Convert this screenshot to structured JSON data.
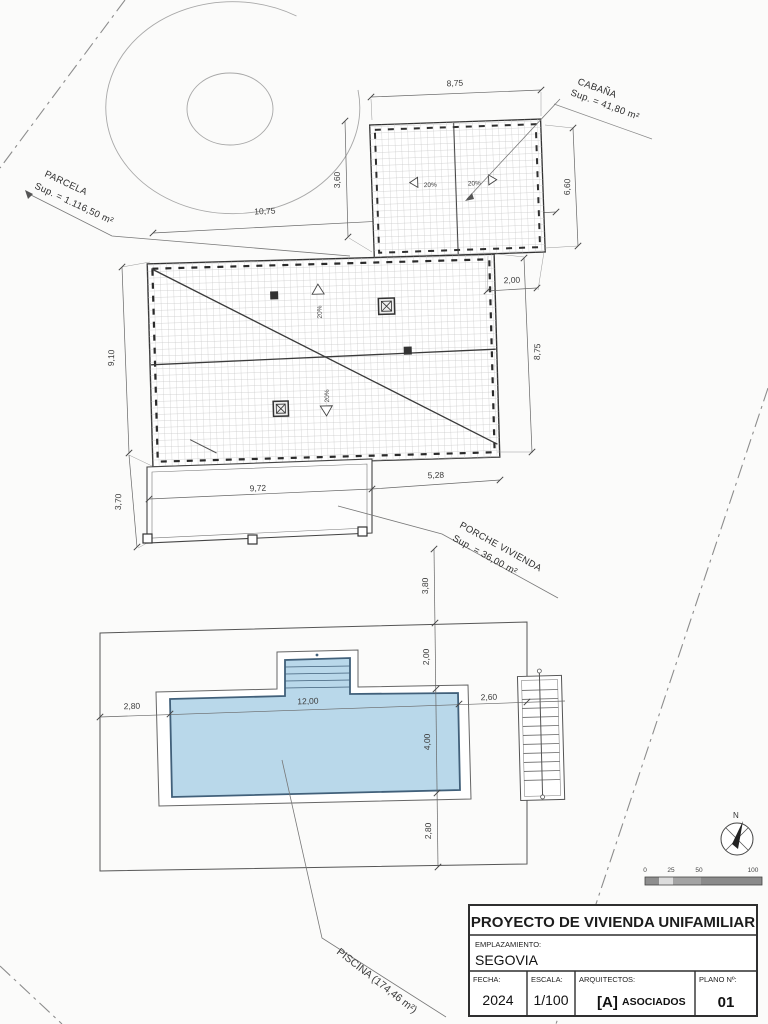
{
  "plan": {
    "labels": {
      "parcela_1": "PARCELA",
      "parcela_2": "Sup. = 1.116,50 m²",
      "cabana_1": "CABAÑA",
      "cabana_2": "Sup. = 41,80 m²",
      "porche_1": "PORCHE VIVIENDA",
      "porche_2": "Sup. = 36,00 m²",
      "piscina": "PISCINA (174,46 m²)",
      "north": "N",
      "slope": "20%"
    },
    "dims": {
      "cabana_top": "8,75",
      "cabana_side": "6,60",
      "cabana_offset": "3,60",
      "site_top": "10,75",
      "gap": "2,00",
      "house_right": "8,75",
      "house_left": "9,10",
      "porch_left": "3,70",
      "porch_bottom_a": "9,72",
      "porch_bottom_b": "5,28",
      "chain_a": "3,80",
      "chain_b": "2,00",
      "pool_width": "4,00",
      "chain_c": "2,80",
      "pool_margin_left": "2,80",
      "pool_length": "12,00",
      "pool_margin_right": "2,60"
    },
    "scalebar": {
      "t0": "0",
      "t25": "25",
      "t50": "50",
      "t100": "100"
    }
  },
  "titleblock": {
    "title": "PROYECTO DE VIVIENDA UNIFAMILIAR",
    "emplazamiento_label": "EMPLAZAMIENTO:",
    "emplazamiento_value": "SEGOVIA",
    "fecha_label": "FECHA:",
    "fecha_value": "2024",
    "escala_label": "ESCALA:",
    "escala_value": "1/100",
    "arquitectos_label": "ARQUITECTOS:",
    "arquitectos_logo": "[A]",
    "arquitectos_value": "ASOCIADOS",
    "plano_label": "PLANO Nº:",
    "plano_value": "01"
  },
  "colors": {
    "pool_fill": "#b9d8ea",
    "pool_stroke": "#41607a",
    "line": "#333333",
    "hatch": "#c7c7c7"
  }
}
